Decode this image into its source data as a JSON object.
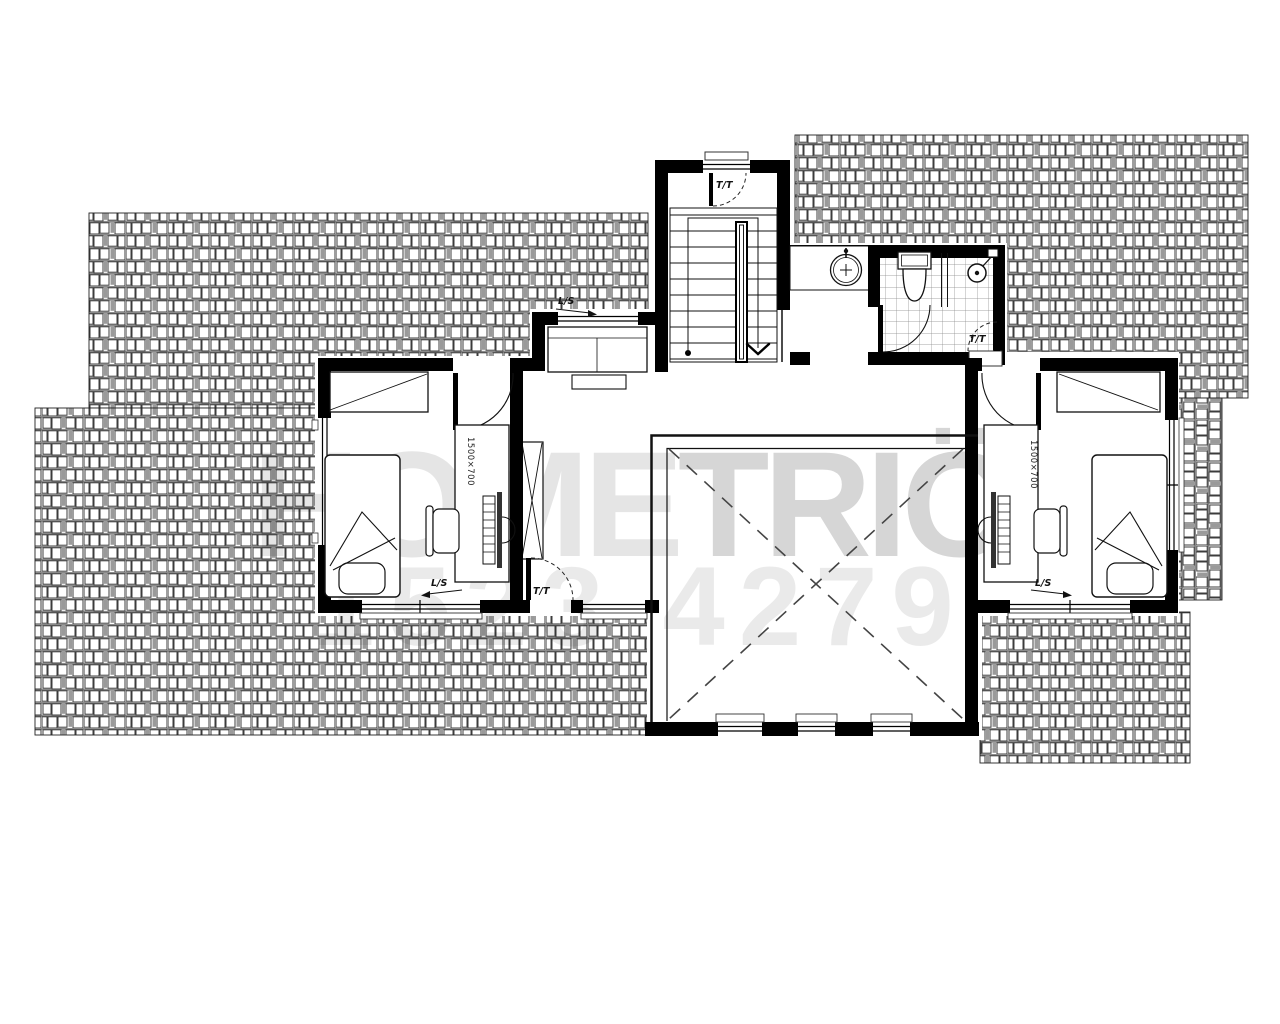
{
  "watermark": {
    "brand_prefix": "HOME",
    "brand_suffix": "TRIÖ",
    "serial": "1523 4279"
  },
  "labels": {
    "door_tag": "T/T",
    "light_switch_tag": "L/S",
    "desk_dimension": "1500×700"
  },
  "colors": {
    "background": "#ffffff",
    "walls": "#000000",
    "linework": "#1a1a1a",
    "roof_hatch_line": "#3c3c3c",
    "tile_line": "#888888",
    "watermark_light": "rgba(0,0,0,0.10)",
    "watermark_bold": "rgba(0,0,0,0.16)",
    "watermark_serial": "rgba(0,0,0,0.082)"
  },
  "plan": {
    "floor": "upper floor plan",
    "rooms": [
      {
        "name": "staircase",
        "features": [
          "two flights with treads",
          "center handrail",
          "direction line with start dot and arrow",
          "entry door tagged T/T",
          "window in top wall"
        ]
      },
      {
        "name": "landing-lobby",
        "features": [
          "vanity counter with round wash basin and faucet"
        ]
      },
      {
        "name": "bathroom",
        "features": [
          "toilet with tank",
          "shower head",
          "glass partition",
          "tiled floor grid",
          "inward swing door",
          "service door tagged T/T"
        ]
      },
      {
        "name": "bedroom-left",
        "features": [
          "bed with pillow and folded blanket",
          "desk 1500×700 with monitor, keyboard, chair",
          "wardrobe with diagonal",
          "window in left wall",
          "window in bottom wall",
          "swing door",
          "L/S switch tag with arrow"
        ]
      },
      {
        "name": "bedroom-right",
        "features": [
          "mirror image of bedroom-left",
          "desk 1500×700",
          "bed",
          "wardrobe",
          "window in right wall",
          "window in bottom wall",
          "L/S switch tag with arrow"
        ]
      },
      {
        "name": "upper-hall",
        "features": [
          "sideboard cabinet",
          "tall wardrobe with cross lines",
          "terrace door tagged T/T",
          "top window with L/S tag",
          "bottom window"
        ]
      },
      {
        "name": "double-height-void",
        "features": [
          "dashed X cross",
          "railing on top and left sides",
          "three windows in bottom wall"
        ]
      }
    ],
    "roof_areas": [
      "upper-left",
      "lower-left",
      "top-right",
      "right-strip-rotated",
      "bottom-right"
    ]
  }
}
